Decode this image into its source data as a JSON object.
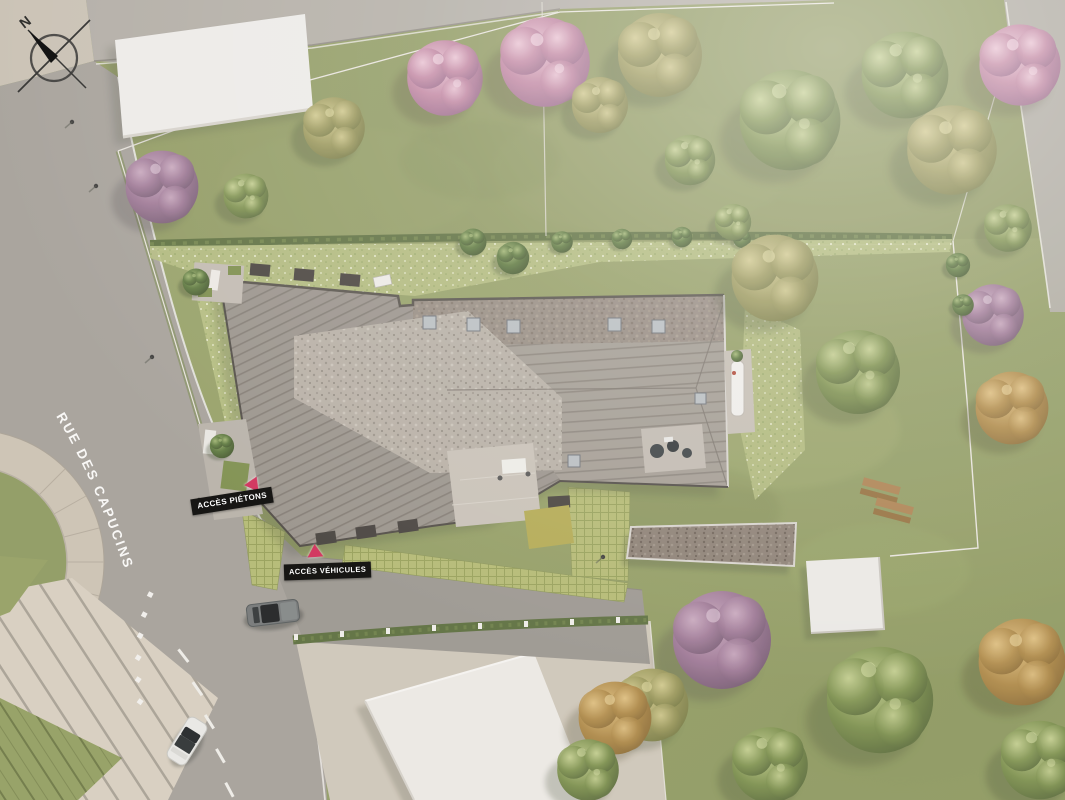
{
  "view": {
    "type": "aerial-site-plan",
    "compass": {
      "label": "N"
    },
    "street": {
      "label": "RUE DES CAPUCINS"
    },
    "access_points": {
      "pedestrian": {
        "label": "ACCÈS PIÉTONS"
      },
      "vehicle": {
        "label": "ACCÈS VÉHICULES"
      }
    },
    "palette": {
      "road": "#a6a29c",
      "road_light": "#b2aea7",
      "sidewalk": "#c9c2b5",
      "lawn": "#95a167",
      "meadow": "#b4be81",
      "hedge": "#5d7040",
      "roof_standing_seam": "#9a948d",
      "roof_gravel_flat": "#b7b0a7",
      "roof_carport": "#8c8076",
      "neighbor_roof_white": "#edecea",
      "green_pavers": "#b4bb75",
      "label_background": "#171614",
      "label_text": "#ffffff",
      "arrow_accent": "#d23a62"
    }
  }
}
